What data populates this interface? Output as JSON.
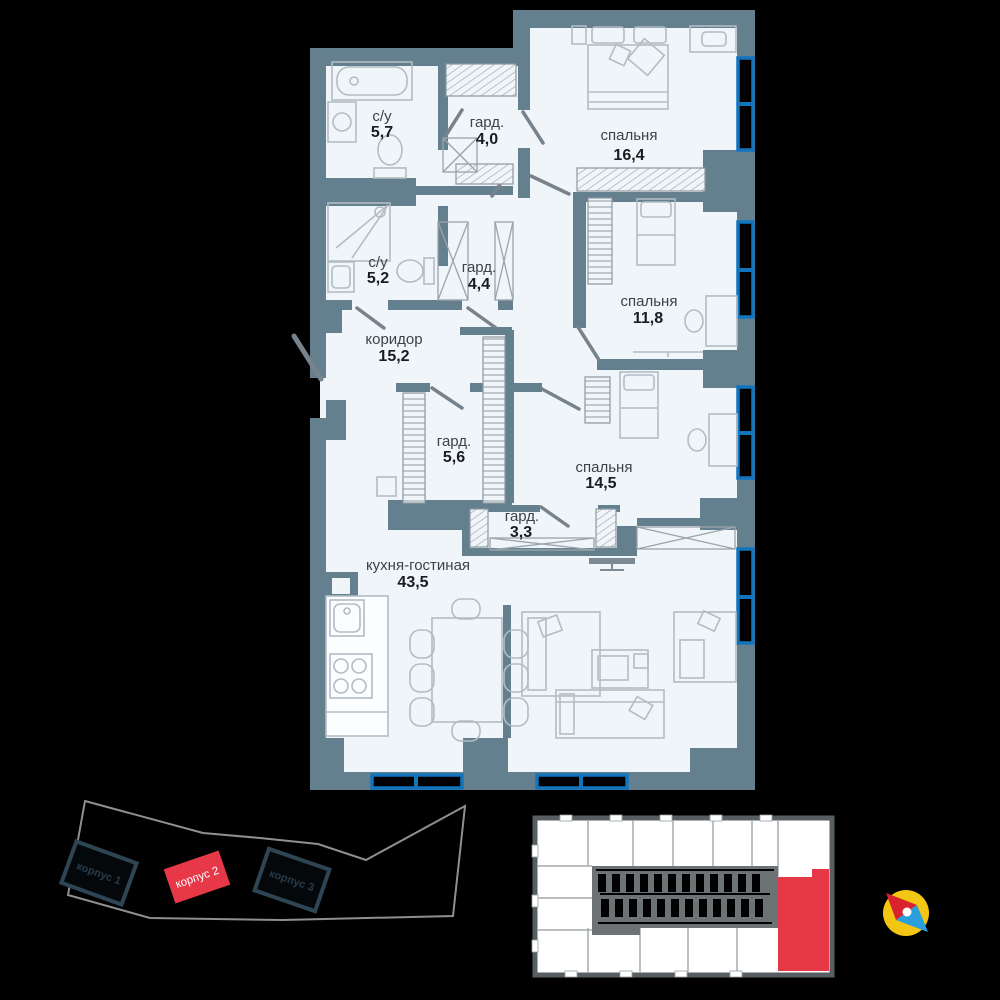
{
  "floor_plan": {
    "rooms": [
      {
        "name": "с/у",
        "area": "5,7"
      },
      {
        "name": "гард.",
        "area": "4,0"
      },
      {
        "name": "спальня",
        "area": "16,4"
      },
      {
        "name": "с/у",
        "area": "5,2"
      },
      {
        "name": "гард.",
        "area": "4,4"
      },
      {
        "name": "спальня",
        "area": "11,8"
      },
      {
        "name": "коридор",
        "area": "15,2"
      },
      {
        "name": "гард.",
        "area": "5,6"
      },
      {
        "name": "спальня",
        "area": "14,5"
      },
      {
        "name": "гард.",
        "area": "3,3"
      },
      {
        "name": "кухня-гостиная",
        "area": "43,5"
      }
    ]
  },
  "site_plan": {
    "buildings": [
      {
        "label": "корпус 1",
        "highlighted": false
      },
      {
        "label": "корпус 2",
        "highlighted": true
      },
      {
        "label": "корпус 3",
        "highlighted": false
      }
    ]
  },
  "key_plan": {
    "highlighted_unit": "selected apartment"
  },
  "colors": {
    "background": "#000000",
    "floor": "#f0f5f9",
    "walls": "#64808e",
    "windows": "#1174bd",
    "highlight_red": "#e73848",
    "compass_circle": "#f4c614",
    "compass_north": "#d8232e",
    "compass_south": "#2b9fdc"
  }
}
